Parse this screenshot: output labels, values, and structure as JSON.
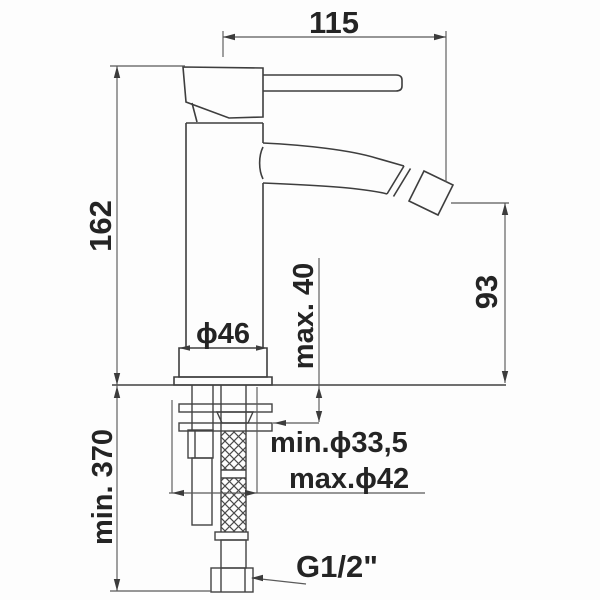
{
  "drawing": {
    "type": "technical-drawing",
    "labels": {
      "spout_reach": "115",
      "total_height": "162",
      "spout_outlet_height": "93",
      "max_deck_thickness": "max. 40",
      "base_diameter": "ϕ46",
      "min_hose_length": "min. 370",
      "min_hole_diameter": "min.ϕ33,5",
      "max_hole_diameter": "max.ϕ42",
      "connection_thread": "G1/2\""
    },
    "colors": {
      "background": "#fdfdfd",
      "object_line": "#3e3e3e",
      "dimension_line": "#5a5a5a",
      "text": "#242424"
    }
  }
}
